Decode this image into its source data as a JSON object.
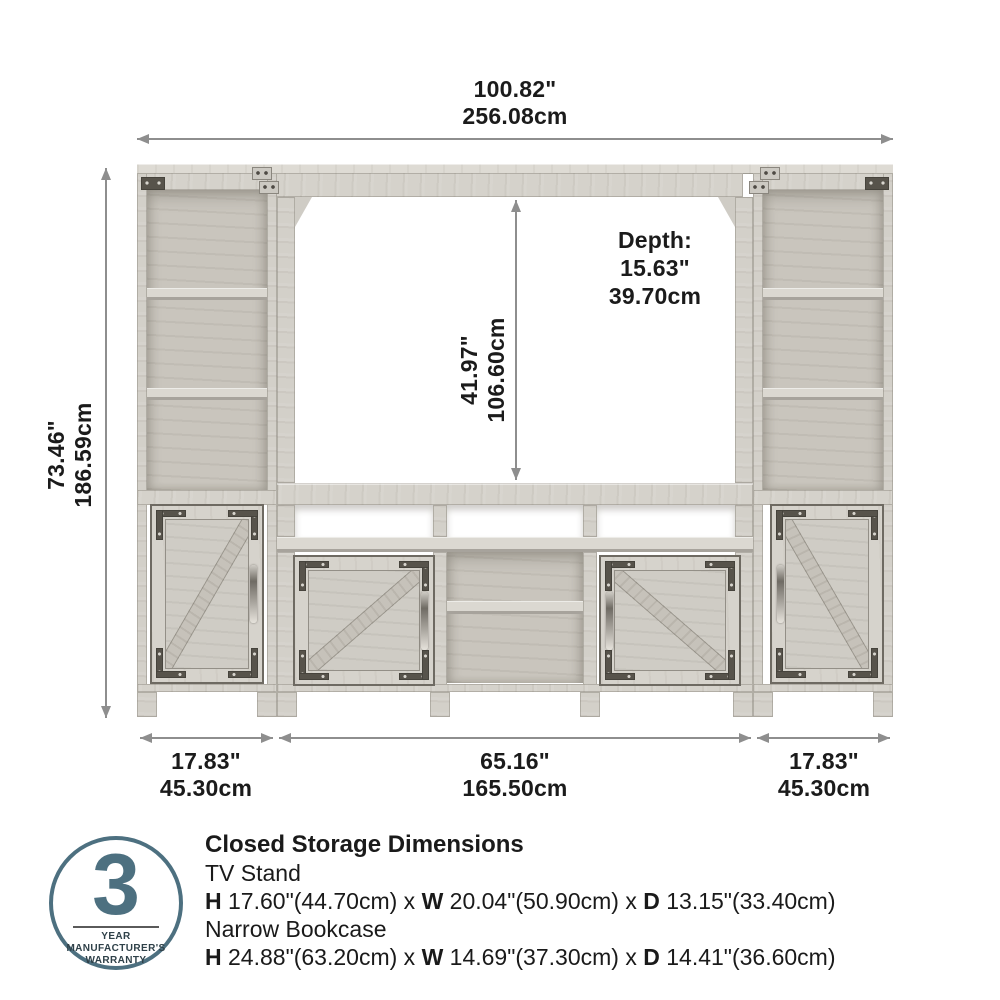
{
  "dims": {
    "width": {
      "in": "100.82\"",
      "cm": "256.08cm"
    },
    "height": {
      "in": "73.46\"",
      "cm": "186.59cm"
    },
    "opening": {
      "in": "41.97\"",
      "cm": "106.60cm"
    },
    "depth": {
      "label": "Depth:",
      "in": "15.63\"",
      "cm": "39.70cm"
    },
    "left": {
      "in": "17.83\"",
      "cm": "45.30cm"
    },
    "center": {
      "in": "65.16\"",
      "cm": "165.50cm"
    },
    "right": {
      "in": "17.83\"",
      "cm": "45.30cm"
    }
  },
  "storage": {
    "title": "Closed Storage Dimensions",
    "items": [
      {
        "name": "TV Stand",
        "parts": {
          "b0": "H",
          "t0": " 17.60\"(44.70cm) x ",
          "b1": "W",
          "t1": " 20.04\"(50.90cm) x ",
          "b2": "D",
          "t2": " 13.15\"(33.40cm)"
        }
      },
      {
        "name": "Narrow Bookcase",
        "parts": {
          "b0": "H",
          "t0": " 24.88\"(63.20cm) x ",
          "b1": "W",
          "t1": " 14.69\"(37.30cm) x ",
          "b2": "D",
          "t2": " 14.41\"(36.60cm)"
        }
      }
    ]
  },
  "badge": {
    "number": "3",
    "line1": "YEAR MANUFACTURER'S",
    "line2": "WARRANTY"
  },
  "colors": {
    "accent": "#4d7080",
    "wood": "#d5d2cb",
    "arrow": "#8e8e8e",
    "metal": "#57534b",
    "text": "#1b1b1b"
  }
}
